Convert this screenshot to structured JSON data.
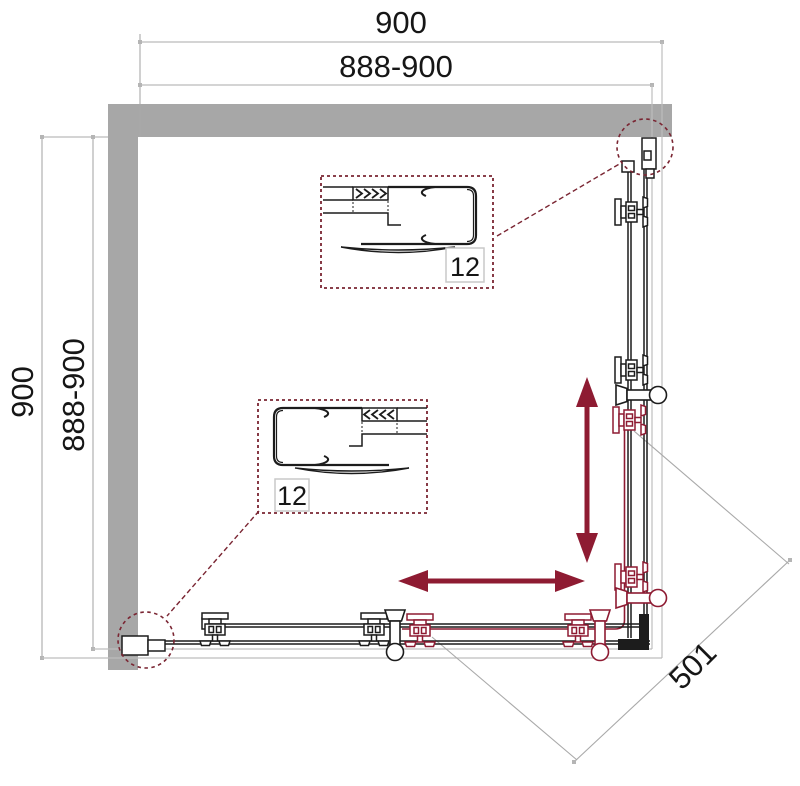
{
  "drawing": {
    "description": "shower-enclosure-corner-top-view",
    "dimensions": {
      "top_outer": "900",
      "top_inner": "888-900",
      "left_outer": "900",
      "left_inner": "888-900",
      "diagonal": "501"
    },
    "callouts": {
      "top_label": "12",
      "bottom_label": "12"
    }
  },
  "colors": {
    "wall": "#a7a7a7",
    "line": "#1c1c1c",
    "dim_line": "#a9a9a9",
    "tray_line": "#bdbdbd",
    "accent": "#8e1b32",
    "callout": "#7a2532",
    "label_box_border": "#c9c9c9",
    "background": "#ffffff"
  }
}
